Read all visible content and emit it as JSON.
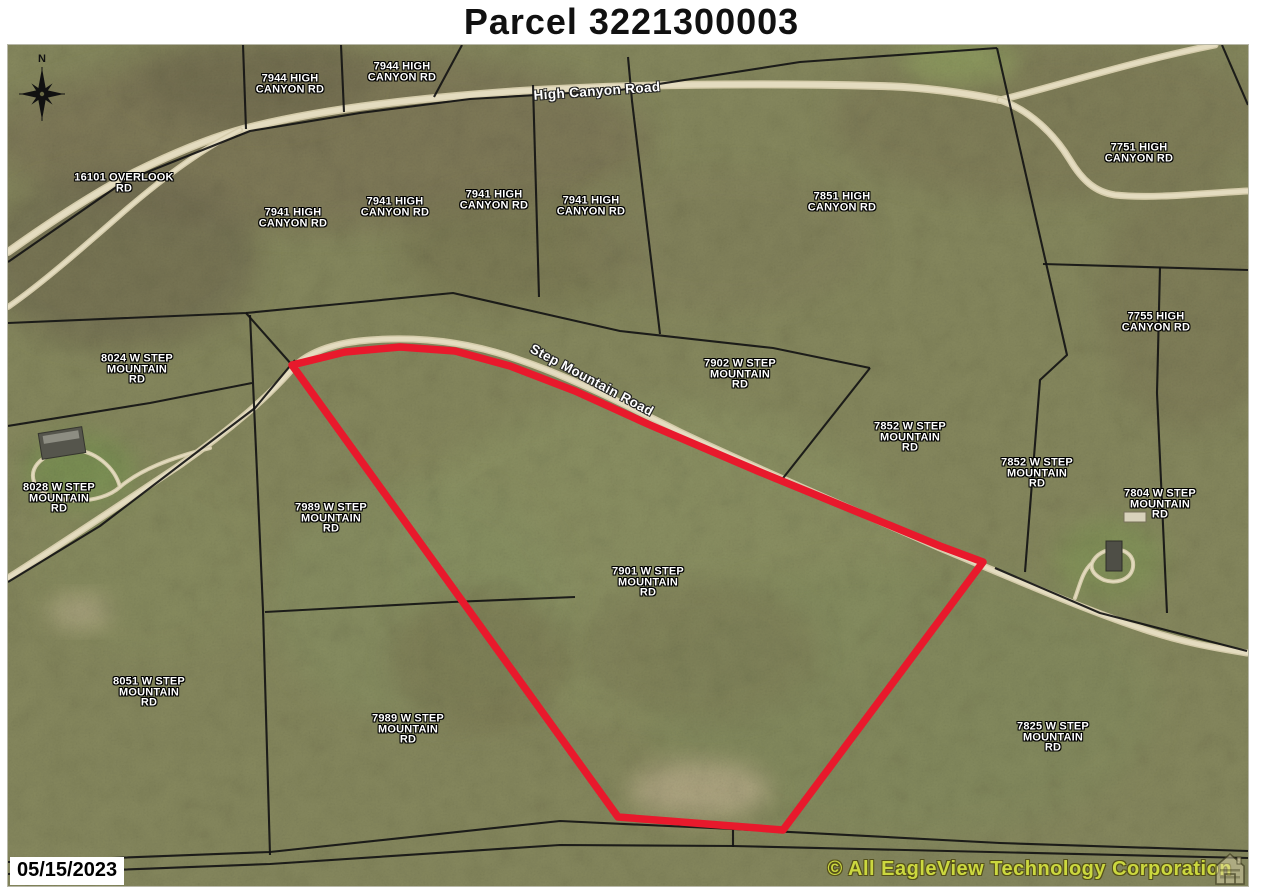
{
  "title": "Parcel 3221300003",
  "date_stamp": "05/15/2023",
  "copyright": "© All EagleView Technology Corporation",
  "north_label": "N",
  "colors": {
    "red_outline": "#e8192c",
    "parcel_line": "#141414",
    "road_fill": "#d5ccab",
    "road_core": "#e4dcc0",
    "label_text": "#ffffff",
    "copyright_text": "#ccd83f",
    "base_terrain": "#87895e"
  },
  "map": {
    "address_labels": [
      {
        "text": "7944 HIGH\nCANYON RD",
        "x": 290,
        "y": 84
      },
      {
        "text": "7944 HIGH\nCANYON RD",
        "x": 402,
        "y": 72
      },
      {
        "text": "16101 OVERLOOK\nRD",
        "x": 124,
        "y": 183
      },
      {
        "text": "7941 HIGH\nCANYON RD",
        "x": 293,
        "y": 218
      },
      {
        "text": "7941 HIGH\nCANYON RD",
        "x": 395,
        "y": 207
      },
      {
        "text": "7941 HIGH\nCANYON RD",
        "x": 494,
        "y": 200
      },
      {
        "text": "7941 HIGH\nCANYON RD",
        "x": 591,
        "y": 206
      },
      {
        "text": "7851 HIGH\nCANYON RD",
        "x": 842,
        "y": 202
      },
      {
        "text": "7751 HIGH\nCANYON RD",
        "x": 1139,
        "y": 153
      },
      {
        "text": "7755 HIGH\nCANYON RD",
        "x": 1156,
        "y": 322
      },
      {
        "text": "8024 W STEP\nMOUNTAIN\nRD",
        "x": 137,
        "y": 369
      },
      {
        "text": "7902 W STEP\nMOUNTAIN\nRD",
        "x": 740,
        "y": 374
      },
      {
        "text": "7852 W STEP\nMOUNTAIN\nRD",
        "x": 910,
        "y": 437
      },
      {
        "text": "7852 W STEP\nMOUNTAIN\nRD",
        "x": 1037,
        "y": 473
      },
      {
        "text": "7804 W STEP\nMOUNTAIN\nRD",
        "x": 1160,
        "y": 504
      },
      {
        "text": "8028 W STEP\nMOUNTAIN\nRD",
        "x": 59,
        "y": 498
      },
      {
        "text": "7989 W STEP\nMOUNTAIN\nRD",
        "x": 331,
        "y": 518
      },
      {
        "text": "7901 W STEP\nMOUNTAIN\nRD",
        "x": 648,
        "y": 582
      },
      {
        "text": "8051 W STEP\nMOUNTAIN\nRD",
        "x": 149,
        "y": 692
      },
      {
        "text": "7989 W STEP\nMOUNTAIN\nRD",
        "x": 408,
        "y": 729
      },
      {
        "text": "7825 W STEP\nMOUNTAIN\nRD",
        "x": 1053,
        "y": 737
      }
    ],
    "road_labels": [
      {
        "text": "High Canyon Road",
        "x": 597,
        "y": 91,
        "rot": -4
      },
      {
        "text": "Step Mountain Road",
        "x": 592,
        "y": 380,
        "rot": 28
      }
    ],
    "red_parcel": {
      "points": [
        [
          292,
          365
        ],
        [
          345,
          352
        ],
        [
          400,
          347
        ],
        [
          455,
          351
        ],
        [
          510,
          366
        ],
        [
          575,
          391
        ],
        [
          650,
          425
        ],
        [
          760,
          472
        ],
        [
          860,
          513
        ],
        [
          940,
          546
        ],
        [
          983,
          562
        ],
        [
          783,
          830
        ],
        [
          618,
          817
        ]
      ]
    },
    "parcel_lines": [
      [
        [
          8,
          262
        ],
        [
          125,
          181
        ],
        [
          250,
          131
        ],
        [
          360,
          113
        ],
        [
          470,
          99
        ],
        [
          620,
          90
        ]
      ],
      [
        [
          620,
          90
        ],
        [
          800,
          62
        ],
        [
          997,
          48
        ]
      ],
      [
        [
          243,
          45
        ],
        [
          246,
          129
        ]
      ],
      [
        [
          341,
          45
        ],
        [
          344,
          112
        ]
      ],
      [
        [
          462,
          45
        ],
        [
          434,
          97
        ]
      ],
      [
        [
          533,
          85
        ],
        [
          539,
          297
        ]
      ],
      [
        [
          628,
          57
        ],
        [
          632,
          101
        ],
        [
          660,
          334
        ]
      ],
      [
        [
          997,
          48
        ],
        [
          1067,
          355
        ],
        [
          1040,
          380
        ],
        [
          1025,
          572
        ]
      ],
      [
        [
          1043,
          264
        ],
        [
          1248,
          270
        ]
      ],
      [
        [
          8,
          323
        ],
        [
          246,
          313
        ],
        [
          350,
          303
        ],
        [
          453,
          293
        ],
        [
          620,
          331
        ],
        [
          773,
          348
        ],
        [
          870,
          368
        ]
      ],
      [
        [
          870,
          368
        ],
        [
          780,
          482
        ]
      ],
      [
        [
          1160,
          267
        ],
        [
          1157,
          393
        ],
        [
          1167,
          613
        ]
      ],
      [
        [
          995,
          568
        ],
        [
          1100,
          613
        ],
        [
          1247,
          651
        ]
      ],
      [
        [
          250,
          315
        ],
        [
          256,
          450
        ],
        [
          263,
          610
        ],
        [
          270,
          855
        ]
      ],
      [
        [
          246,
          313
        ],
        [
          292,
          365
        ]
      ],
      [
        [
          252,
          383
        ],
        [
          150,
          403
        ],
        [
          8,
          426
        ]
      ],
      [
        [
          265,
          612
        ],
        [
          452,
          602
        ],
        [
          575,
          597
        ]
      ],
      [
        [
          8,
          862
        ],
        [
          270,
          852
        ],
        [
          560,
          821
        ],
        [
          733,
          829
        ],
        [
          1000,
          843
        ],
        [
          1248,
          851
        ]
      ],
      [
        [
          8,
          874
        ],
        [
          270,
          864
        ],
        [
          560,
          845
        ],
        [
          733,
          846
        ],
        [
          1248,
          858
        ]
      ],
      [
        [
          733,
          829
        ],
        [
          733,
          847
        ]
      ],
      [
        [
          295,
          360
        ],
        [
          255,
          408
        ],
        [
          180,
          465
        ],
        [
          100,
          526
        ],
        [
          8,
          582
        ]
      ],
      [
        [
          1222,
          45
        ],
        [
          1248,
          105
        ]
      ]
    ],
    "roads": [
      {
        "name": "high-canyon-road",
        "w": 8,
        "d": "M8,252 C60,215 100,190 135,172 C180,150 220,134 255,126 C330,108 420,98 520,91 C640,84 760,83 880,86 C920,87 960,92 1000,100"
      },
      {
        "name": "high-canyon-road-corner-branch",
        "w": 7,
        "d": "M1000,100 C1060,85 1130,62 1215,45"
      },
      {
        "name": "high-canyon-road-east-branch",
        "w": 7,
        "d": "M1000,100 C1030,110 1055,135 1070,160 C1082,180 1095,192 1115,195 C1155,199 1205,193 1247,191"
      },
      {
        "name": "overlook-road",
        "w": 6,
        "d": "M8,307 C40,285 80,250 120,215 C160,180 200,150 240,130"
      },
      {
        "name": "step-mountain-road",
        "w": 7,
        "d": "M8,578 C60,545 120,505 180,465 C230,430 270,395 293,368 C310,350 340,342 370,340 C420,336 470,342 520,360 C570,377 620,402 680,432 C760,470 850,508 940,548 C1000,573 1080,608 1140,628 C1180,642 1215,648 1247,653"
      },
      {
        "name": "driveway-8028",
        "w": 4,
        "d": "M210,448 C170,458 140,470 120,487 C100,505 55,505 38,488 C24,472 40,452 70,450 C95,449 115,468 120,487"
      },
      {
        "name": "driveway-7804",
        "w": 4,
        "d": "M1075,598 C1080,585 1082,572 1092,563 C1100,545 1130,545 1133,562 C1135,578 1118,585 1104,580 C1095,576 1090,570 1092,563"
      }
    ]
  }
}
